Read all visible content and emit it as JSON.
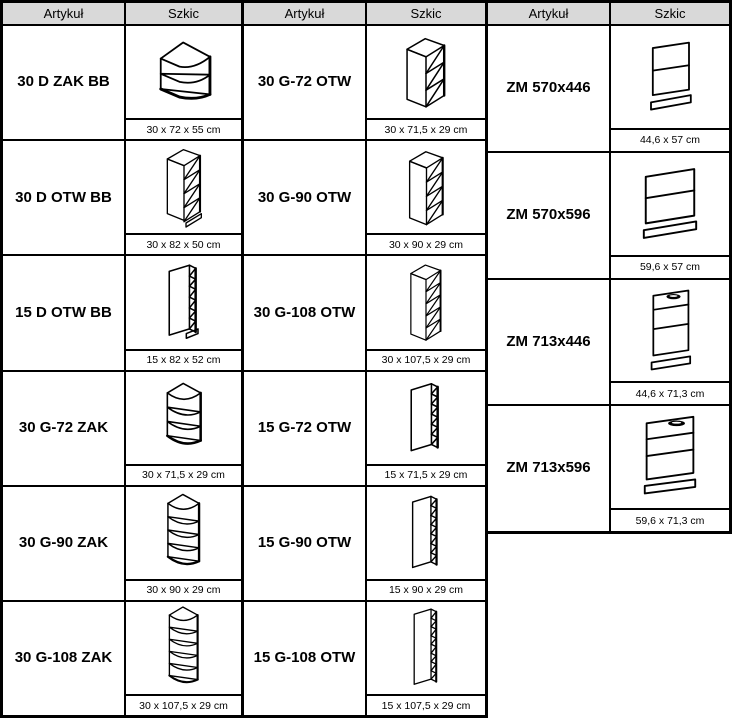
{
  "headers": {
    "article": "Artykuł",
    "sketch": "Szkic"
  },
  "tables": [
    {
      "rows": [
        {
          "article": "30 D ZAK BB",
          "dims": "30 x 72 x 55 cm"
        },
        {
          "article": "30 D OTW BB",
          "dims": "30 x 82 x 50 cm"
        },
        {
          "article": "15 D OTW BB",
          "dims": "15 x 82 x 52 cm"
        },
        {
          "article": "30 G-72 ZAK",
          "dims": "30 x 71,5 x 29 cm"
        },
        {
          "article": "30 G-90 ZAK",
          "dims": "30 x 90 x 29 cm"
        },
        {
          "article": "30 G-108 ZAK",
          "dims": "30 x 107,5 x 29 cm"
        }
      ]
    },
    {
      "rows": [
        {
          "article": "30 G-72 OTW",
          "dims": "30 x 71,5 x 29 cm"
        },
        {
          "article": "30 G-90 OTW",
          "dims": "30 x 90 x 29 cm"
        },
        {
          "article": "30 G-108 OTW",
          "dims": "30 x 107,5 x 29 cm"
        },
        {
          "article": "15 G-72 OTW",
          "dims": "15 x 71,5 x 29 cm"
        },
        {
          "article": "15 G-90 OTW",
          "dims": "15 x 90 x 29 cm"
        },
        {
          "article": "15 G-108 OTW",
          "dims": "15 x 107,5 x 29 cm"
        }
      ]
    },
    {
      "rows": [
        {
          "article": "ZM 570x446",
          "dims": "44,6 x 57 cm"
        },
        {
          "article": "ZM 570x596",
          "dims": "59,6 x 57 cm"
        },
        {
          "article": "ZM 713x446",
          "dims": "44,6 x 71,3 cm"
        },
        {
          "article": "ZM 713x596",
          "dims": "59,6 x 71,3 cm"
        }
      ]
    }
  ]
}
